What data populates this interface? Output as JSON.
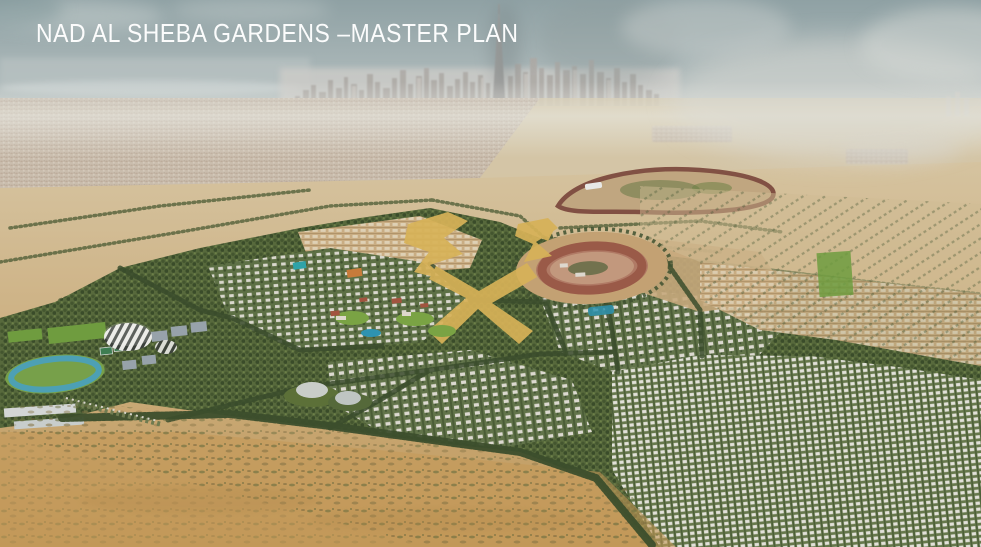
{
  "title": "NAD AL SHEBA GARDENS –MASTER PLAN",
  "colors": {
    "title_text": "#ffffff",
    "sky_top": "#8fa1a4",
    "sky_horizon": "#c9d0ce",
    "haze_white": "#dcdcd6",
    "sand_light": "#d8c9a9",
    "sand_deep": "#bf9759",
    "scrub_olive": "#6b6f3f",
    "greenery_dark": "#44562f",
    "greenery_mid": "#57693c",
    "lawn_green": "#7aa344",
    "villa_roof_white": "#e2e1d9",
    "racetrack_clay": "#9a5a48",
    "meydan_track_brown": "#7d4b3f",
    "gold_highlight": "#d7b258",
    "pool_blue": "#2e93b0",
    "athletics_track_blue": "#4da0b4",
    "skyline_gray": "#aeaba7"
  },
  "landmarks": {
    "sky": "hazy-sky-with-clouds",
    "skyline": "dubai-skyline",
    "tallest_tower": "burj-khalifa-spire",
    "background_city": "distant-city-sprawl",
    "racecourse_far": "meydan-racecourse",
    "racetrack_near": "oval-racetrack",
    "highlight": "gold-highlighted-parcels",
    "park": "central-park-with-pool",
    "housing": "villa-districts",
    "sports": "sports-complex-striped-dome",
    "foreground": "desert-scrub-foreground"
  }
}
